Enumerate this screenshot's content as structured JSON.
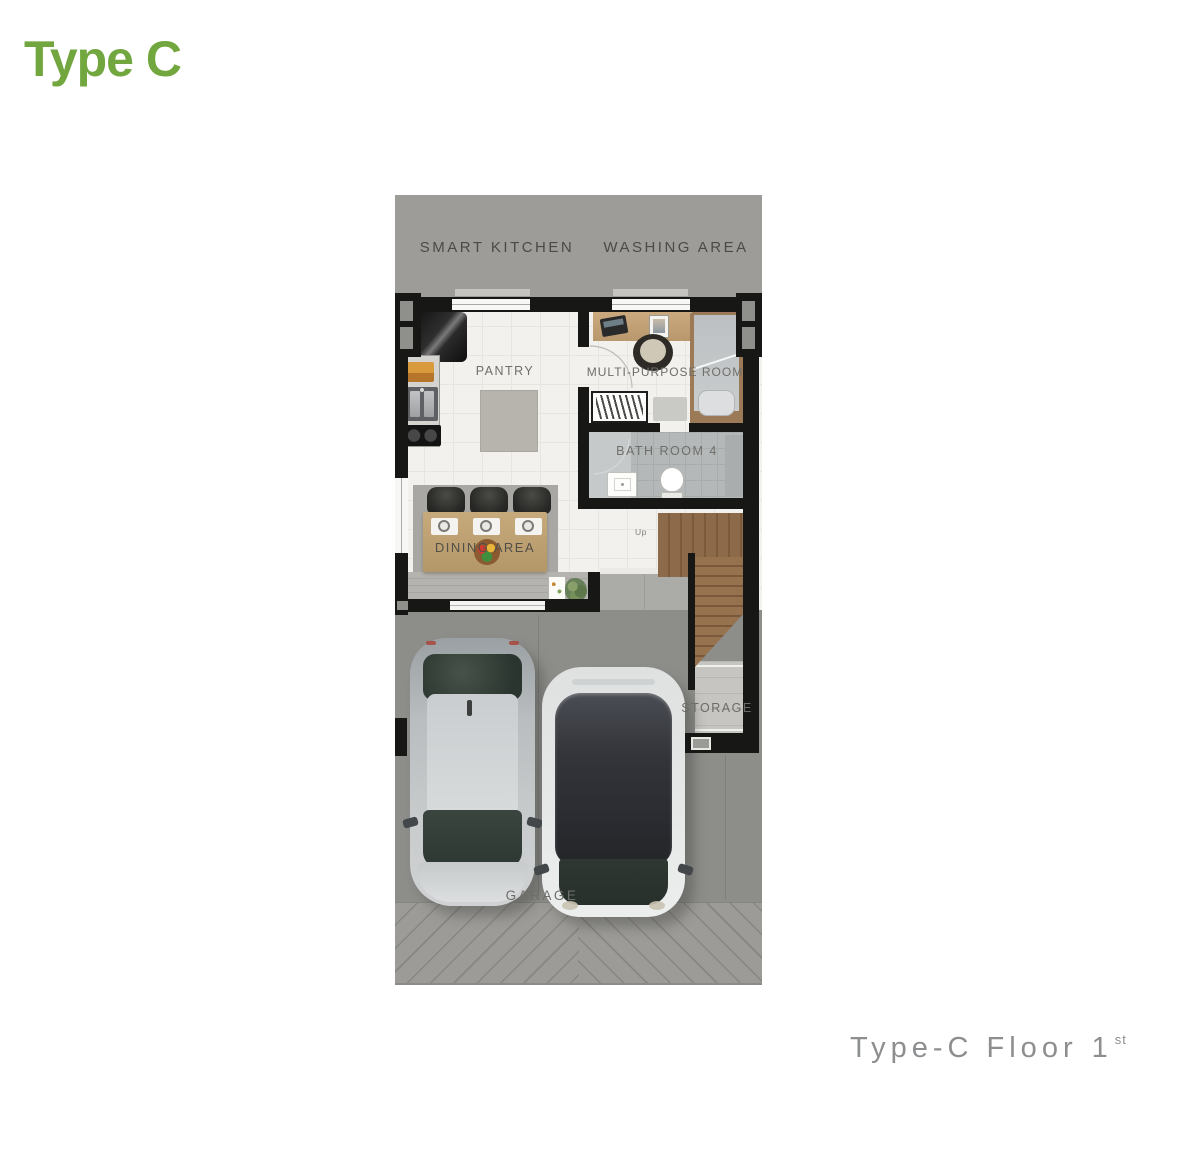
{
  "page": {
    "title": "Type C",
    "caption": {
      "text": "Type-C Floor",
      "number": "1",
      "ordinal": "st"
    }
  },
  "plan": {
    "labels": {
      "smart_kitchen": "SMART KITCHEN",
      "washing_area": "WASHING AREA",
      "pantry": "PANTRY",
      "multi_purpose_room": "MULTI-PURPOSE ROOM",
      "bath_room": "BATH ROOM 4",
      "dining_area": "DINING AREA",
      "storage": "STORAGE",
      "garage": "GARAGE",
      "stairs_up": "Up"
    },
    "colors": {
      "accent_green": "#72a63e",
      "caption_gray": "#8d8e90",
      "wall": "#171716",
      "outdoor_gray": "#9e9c99",
      "garage_gray": "#8d8d8a",
      "floor_white": "#f2f1ed",
      "bath_gray": "#b4b8b8",
      "stair_wood": "#8a6848",
      "table_wood": "#bfa173"
    }
  }
}
